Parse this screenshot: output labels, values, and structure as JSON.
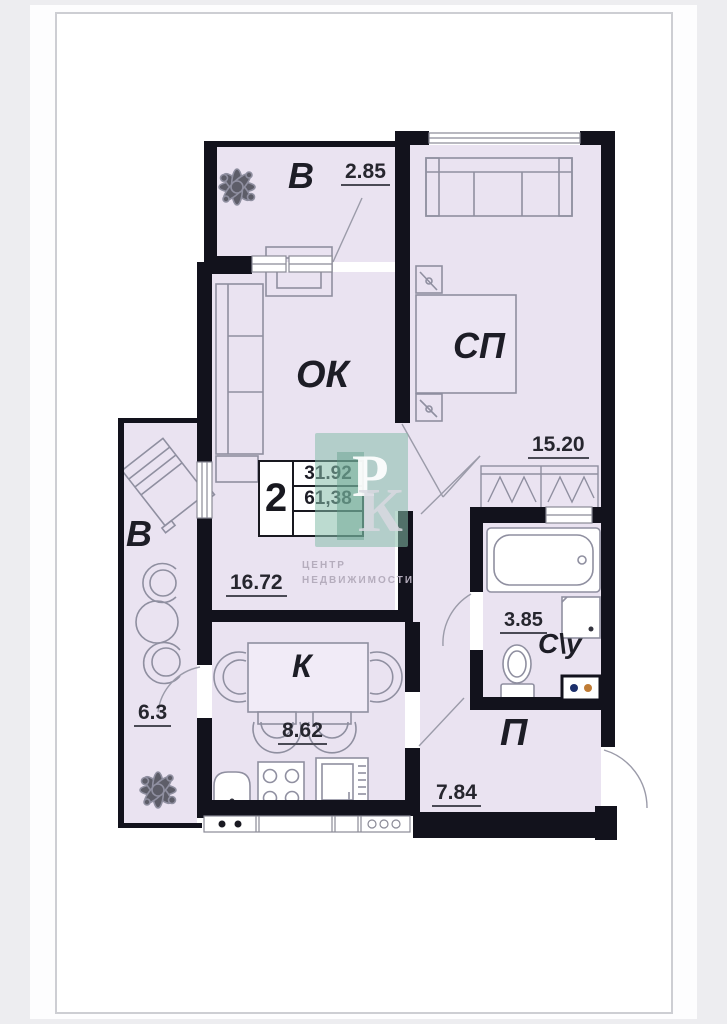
{
  "plan": {
    "rooms": {
      "balcony_top": {
        "label": "В",
        "area": "2.85"
      },
      "bedroom": {
        "label": "СП",
        "area": "15.20"
      },
      "living": {
        "label": "ОК",
        "area": "16.72"
      },
      "balcony_left": {
        "label": "В",
        "area": "6.3"
      },
      "kitchen": {
        "label": "К",
        "area": "8.62"
      },
      "bathroom": {
        "label": "С\\у",
        "area": "3.85"
      },
      "hall": {
        "label": "П",
        "area": "7.84"
      }
    },
    "stamp": {
      "rooms_count": "2",
      "living_area": "31.92",
      "total_area": "61,38"
    },
    "watermark": {
      "letter_top": "Р",
      "letter_bottom": "К",
      "caption_line1": "ЦЕНТР",
      "caption_line2": "НЕДВИЖИМОСТИ"
    },
    "colors": {
      "room_fill": "#eae3f1",
      "wall": "#12121c",
      "watermark_teal": "#7fb8a6",
      "dim_underline": "#4a4a55",
      "vent_dot_blue": "#1c2f6b",
      "vent_dot_orange": "#c07c35"
    }
  }
}
